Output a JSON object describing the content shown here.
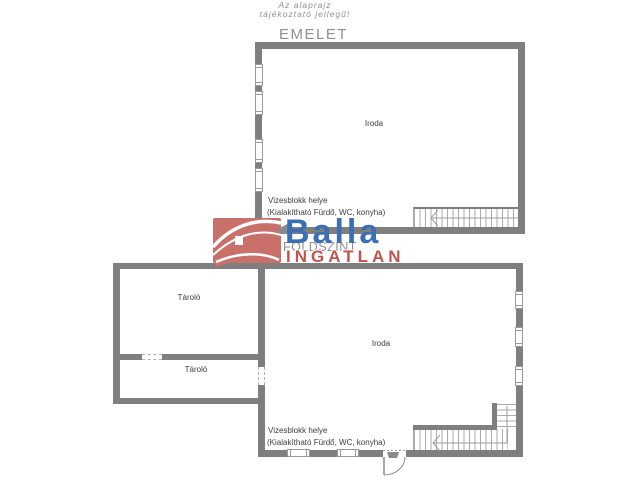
{
  "disclaimer": {
    "line1": "Az alaprajz",
    "line2": "tájékoztató jellegű!"
  },
  "floors": {
    "upper": {
      "title": "EMELET",
      "room_iroda": "Iroda",
      "note_line1": "Vizesblokk helye",
      "note_line2": "(Kialakítható Fürdő, WC, konyha)"
    },
    "ground": {
      "title": "FÖLDSZINT",
      "room_taro1": "Tároló",
      "room_taro2": "Tároló",
      "room_iroda": "Iroda",
      "note_line1": "Vizesblokk helye",
      "note_line2": "(Kialakítható Fürdő, WC, konyha)"
    }
  },
  "watermark": {
    "brand": "Balla",
    "brand_sub": "INGATLAN"
  },
  "colors": {
    "wall_gray": "#7f7f7f",
    "line_gray": "#9e9e9e",
    "label_text": "#3d3d3d",
    "muted_gray": "#8f8f8f",
    "brand_blue": "#3a6fb5",
    "brand_red": "#c2534f",
    "logo_red": "#c9706b"
  }
}
